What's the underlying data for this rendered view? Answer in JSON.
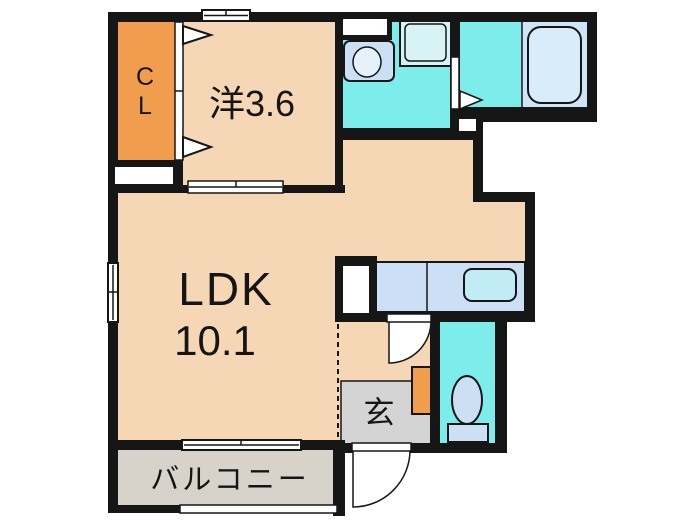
{
  "colors": {
    "wall": "#161616",
    "room": "#f5d6b5",
    "closet": "#f09d4e",
    "wet": "#7cedeb",
    "fixture": "#cbe0f4",
    "basin": "#e6f2fb",
    "pan": "#d7f3f6",
    "tub-area": "#cfe4f6",
    "tub": "#d9ecf9",
    "sink": "#c2ecf5",
    "balcony": "#d7d3cb",
    "genkan": "#d4d4d4"
  },
  "rooms": {
    "closet": {
      "label": "CL"
    },
    "western": {
      "label": "洋3.6"
    },
    "ldk": {
      "label": "LDK",
      "area": "10.1"
    },
    "entrance": {
      "label": "玄"
    },
    "balcony": {
      "label": "バルコニー"
    }
  }
}
